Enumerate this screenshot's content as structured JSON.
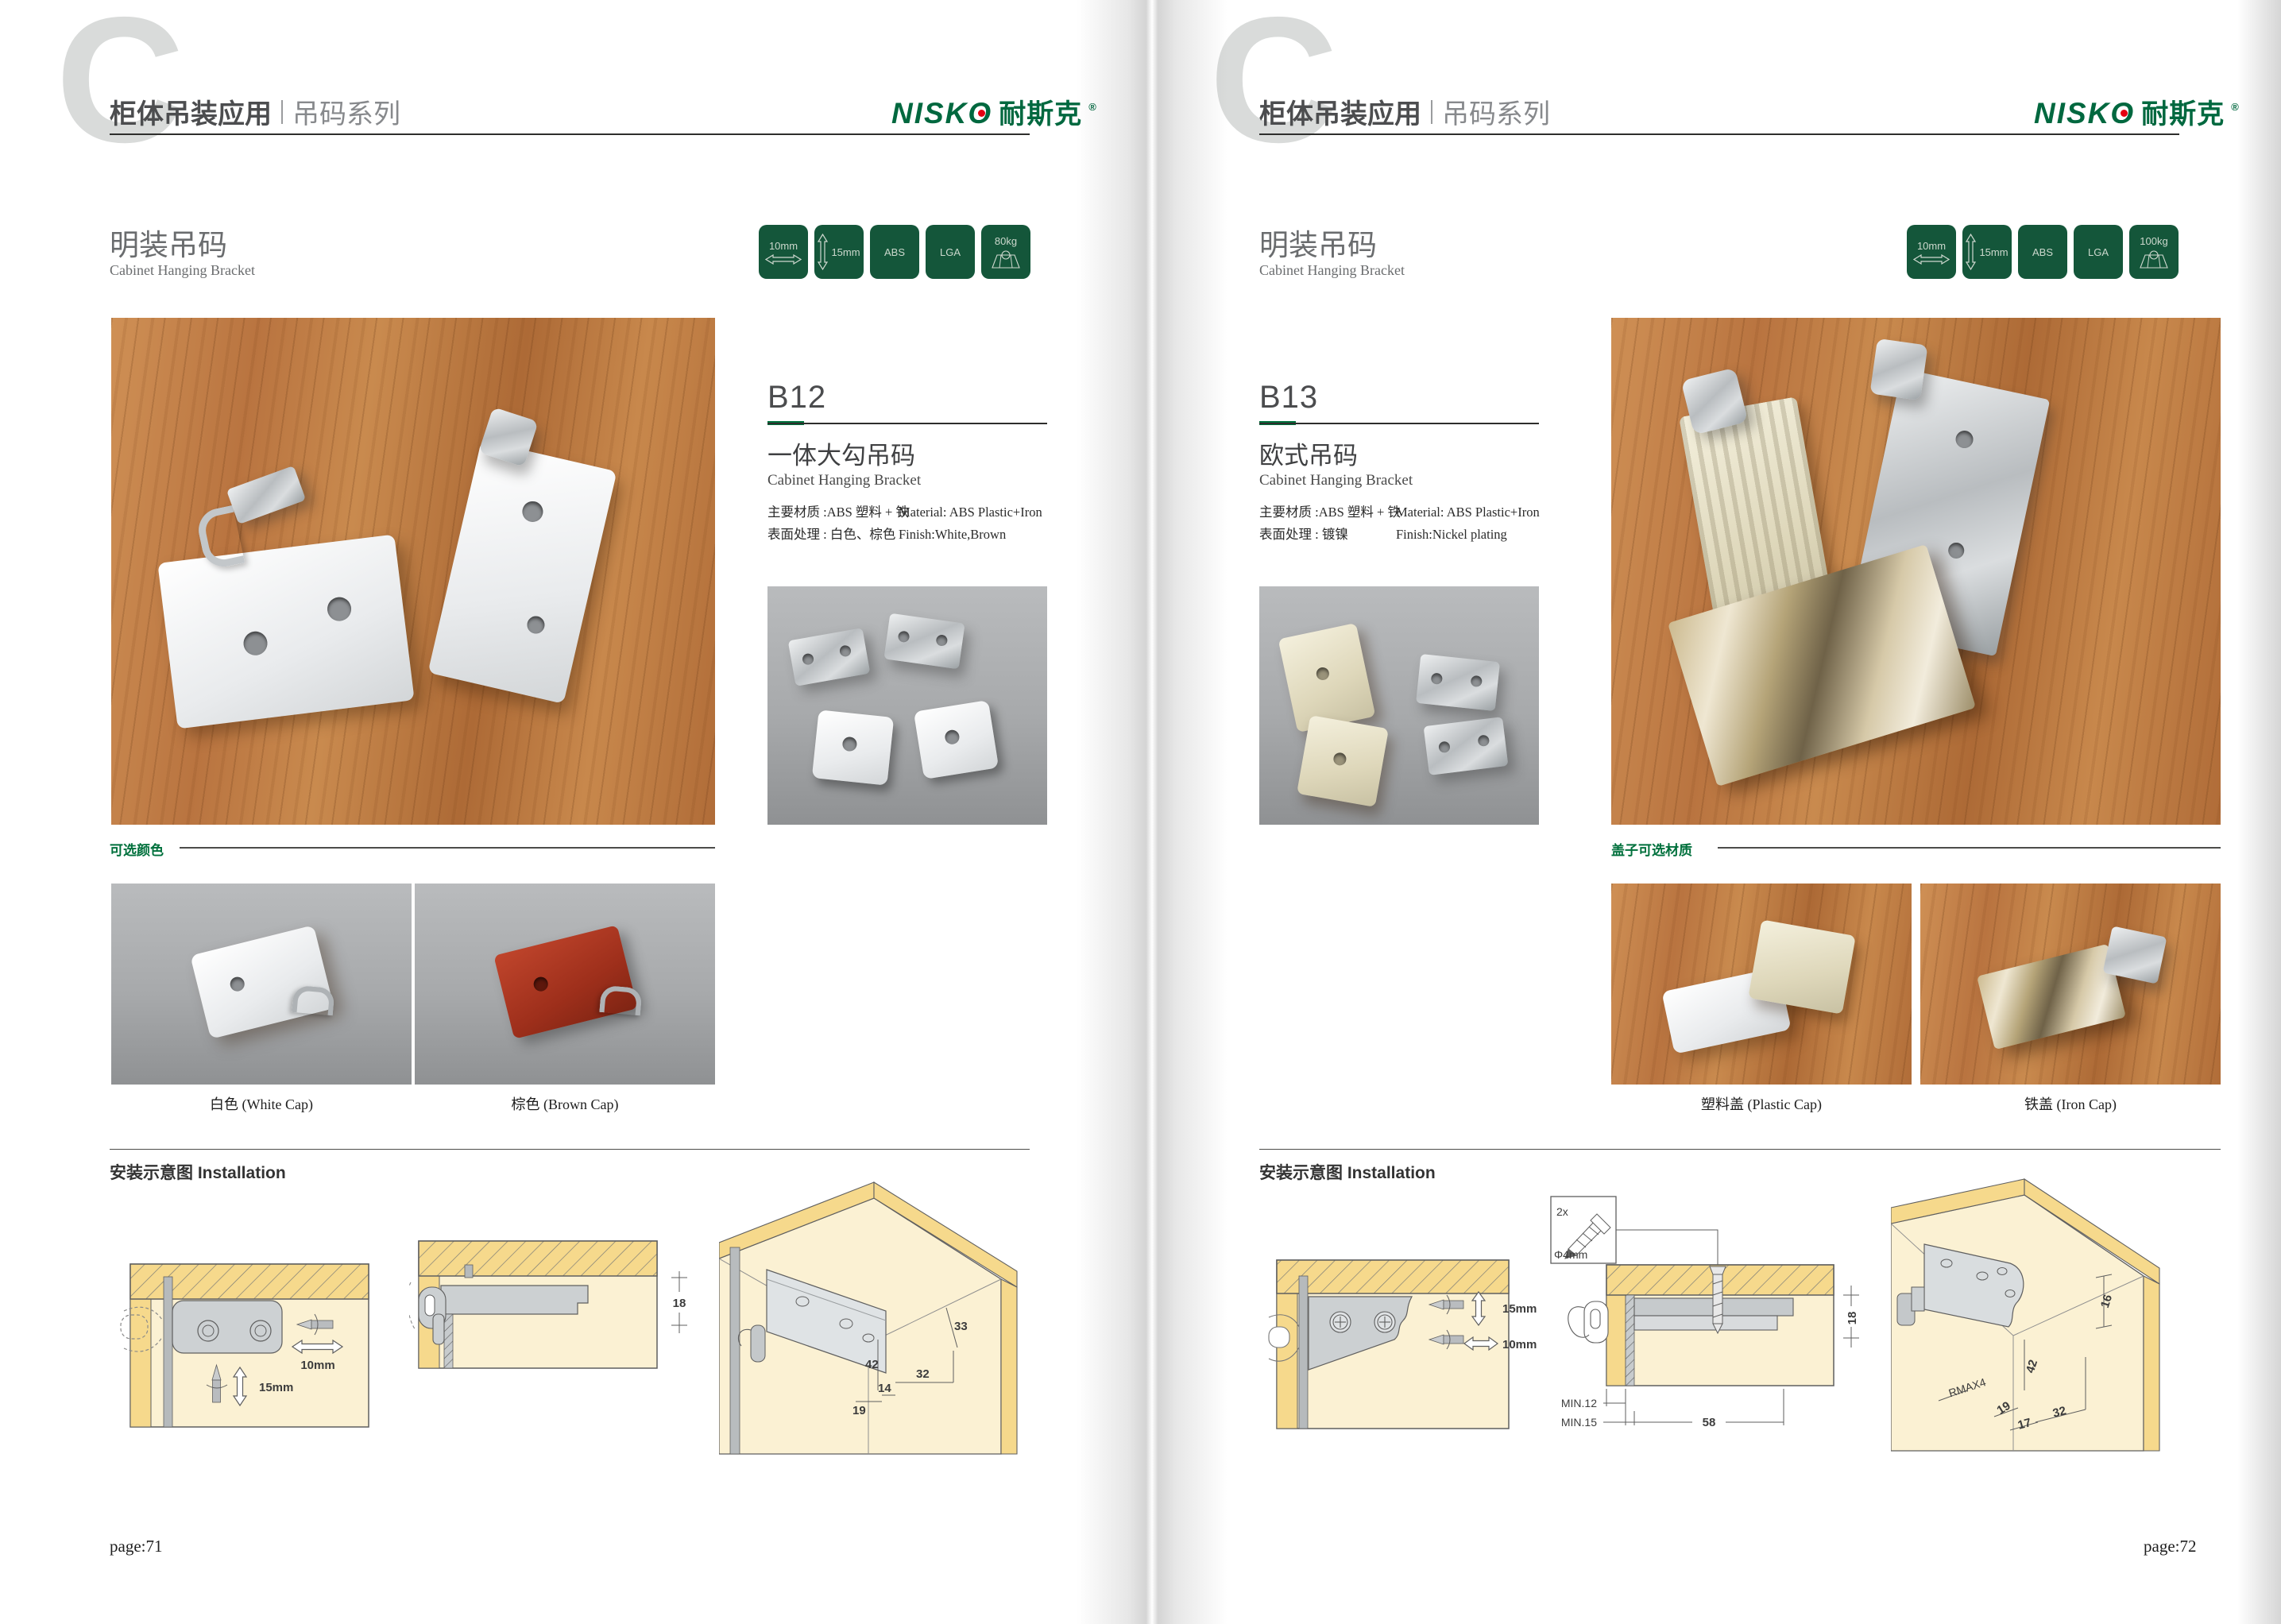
{
  "colors": {
    "brand_green": "#00683F",
    "badge_green": "#14563A",
    "logo_red": "#E60012",
    "rule_dark": "#2E2E2C",
    "wood_brown": "#BE7A44",
    "diagram_cream": "#FBF1D3",
    "diagram_yellow": "#F6D98C"
  },
  "pages": [
    {
      "page_number": "page:71",
      "header": {
        "watermark_letter": "C",
        "title": "柜体吊装应用",
        "subtitle": "吊码系列",
        "logo_latin": "NISKO",
        "logo_cn": "耐斯克",
        "logo_reg": "®"
      },
      "section": {
        "title_cn": "明装吊码",
        "title_en": "Cabinet Hanging Bracket"
      },
      "badges": [
        {
          "label": "10mm",
          "icon": "width-arrow"
        },
        {
          "label": "15mm",
          "icon": "height-arrow"
        },
        {
          "label": "ABS",
          "icon": "none"
        },
        {
          "label": "LGA",
          "icon": "none"
        },
        {
          "label": "80kg",
          "icon": "load-cabinet"
        }
      ],
      "product": {
        "code": "B12",
        "name_cn": "一体大勾吊码",
        "name_en": "Cabinet Hanging Bracket",
        "material_cn": "主要材质 :ABS 塑料 + 铁",
        "material_en": "Material: ABS Plastic+Iron",
        "finish_cn": "表面处理 : 白色、棕色",
        "finish_en": "Finish:White,Brown"
      },
      "options": {
        "label": "可选颜色",
        "captions": [
          "白色 (White Cap)",
          "棕色 (Brown Cap)"
        ]
      },
      "installation": {
        "label": "安装示意图 Installation",
        "diagram1_dims": [
          "10mm",
          "15mm"
        ],
        "diagram2_dims": [
          "18"
        ],
        "diagram3_dims": [
          "33",
          "42",
          "32",
          "19",
          "14"
        ]
      }
    },
    {
      "page_number": "page:72",
      "header": {
        "watermark_letter": "C",
        "title": "柜体吊装应用",
        "subtitle": "吊码系列",
        "logo_latin": "NISKO",
        "logo_cn": "耐斯克",
        "logo_reg": "®"
      },
      "section": {
        "title_cn": "明装吊码",
        "title_en": "Cabinet Hanging Bracket"
      },
      "badges": [
        {
          "label": "10mm",
          "icon": "width-arrow"
        },
        {
          "label": "15mm",
          "icon": "height-arrow"
        },
        {
          "label": "ABS",
          "icon": "none"
        },
        {
          "label": "LGA",
          "icon": "none"
        },
        {
          "label": "100kg",
          "icon": "load-cabinet"
        }
      ],
      "product": {
        "code": "B13",
        "name_cn": "欧式吊码",
        "name_en": "Cabinet Hanging Bracket",
        "material_cn": "主要材质 :ABS 塑料 + 铁",
        "material_en": "Material: ABS Plastic+Iron",
        "finish_cn": "表面处理 : 镀镍",
        "finish_en": "Finish:Nickel plating"
      },
      "options": {
        "label": "盖子可选材质",
        "captions": [
          "塑料盖 (Plastic Cap)",
          "铁盖 (Iron Cap)"
        ]
      },
      "installation": {
        "label": "安装示意图 Installation",
        "screw_note": {
          "qty": "2x",
          "dia": "Φ4mm"
        },
        "diagram1_dims": [
          "15mm",
          "10mm"
        ],
        "diagram2_dims": [
          "18",
          "MIN.12",
          "MIN.15",
          "58"
        ],
        "diagram3_dims": [
          "16",
          "42",
          "RMAX4",
          "19",
          "17",
          "32"
        ]
      }
    }
  ]
}
